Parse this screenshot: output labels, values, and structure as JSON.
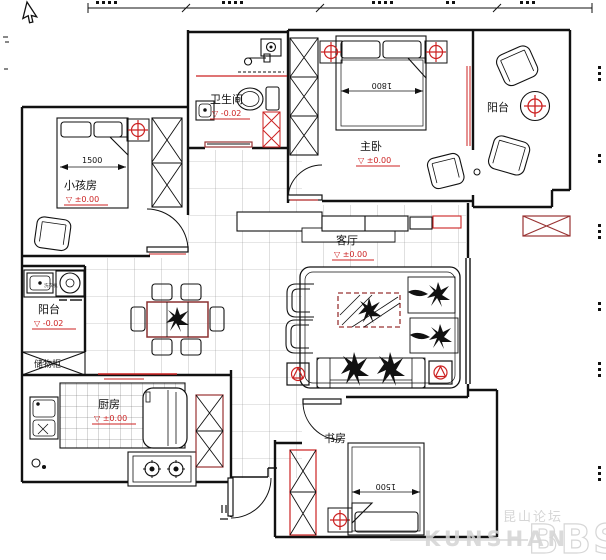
{
  "colors": {
    "red": "#cc2222",
    "dark_red": "#993333",
    "line": "#111111",
    "tile": "#999999",
    "watermark": "#d0d0d0"
  },
  "labels": {
    "children_room": "小孩房",
    "children_elev": "▽ ±0.00",
    "children_bed_dim": "1500",
    "bathroom": "卫生间",
    "bathroom_elev": "▽ -0.02",
    "master": "主卧",
    "master_elev": "▽ ±0.00",
    "master_bed_dim": "1800",
    "balcony_tr": "阳台",
    "living": "客厅",
    "living_elev": "▽ ±0.00",
    "balcony_left": "阳台",
    "balcony_left_elev": "▽ -0.02",
    "storage": "储物柜",
    "kitchen": "厨房",
    "kitchen_elev": "▽ ±0.00",
    "study": "书房",
    "study_bed_dim": "1500",
    "washer": "洗衣机"
  },
  "watermark": {
    "cn": "昆山论坛",
    "en": "KUNSHAN",
    "bbs": "BBS"
  }
}
